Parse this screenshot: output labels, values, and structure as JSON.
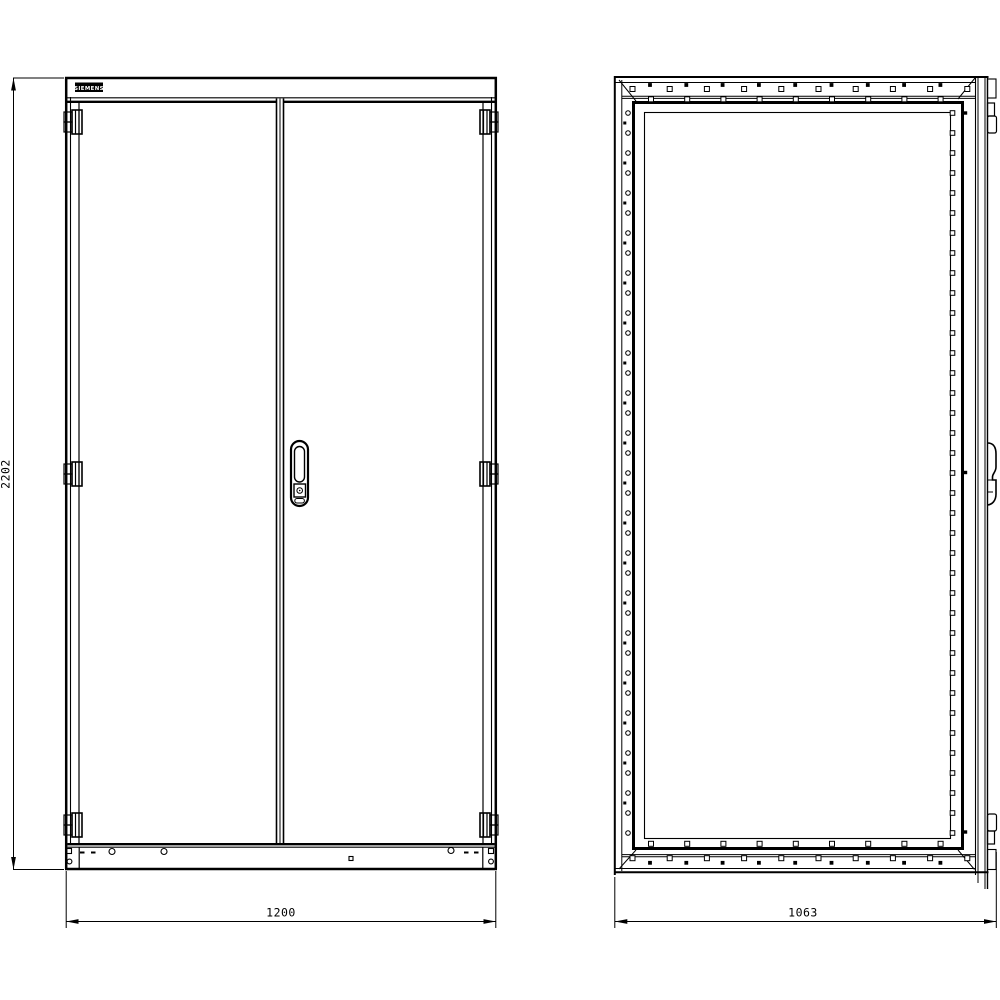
{
  "logo": {
    "text": "SIEMENS"
  },
  "dimensions": {
    "height": "2202",
    "width": "1200",
    "depth": "1063"
  },
  "colors": {
    "line": "#000000",
    "background": "#ffffff"
  }
}
